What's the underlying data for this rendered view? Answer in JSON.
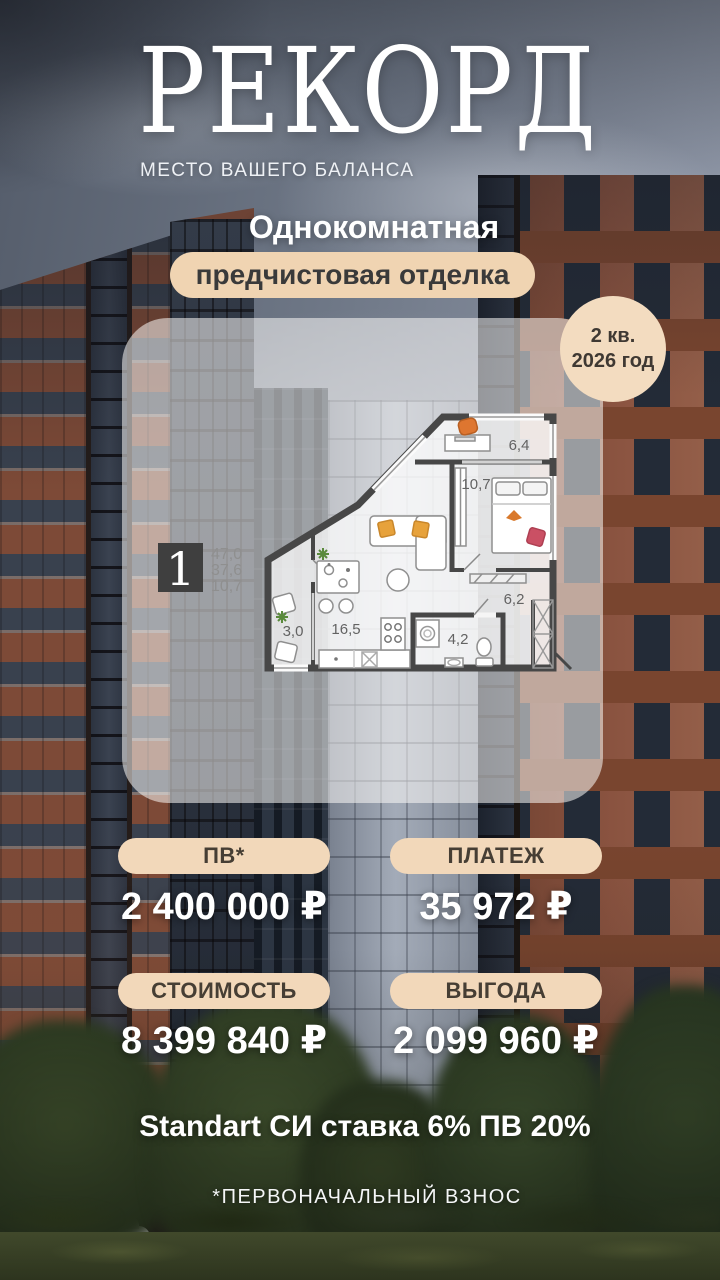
{
  "brand": {
    "logo": "РЕКОРД",
    "tagline": "МЕСТО ВАШЕГО БАЛАНСА"
  },
  "offer": {
    "room_type": "Однокомнатная",
    "finish": "предчистовая отделка",
    "completion_quarter": "2 кв.",
    "completion_year": "2026 год"
  },
  "floorplan": {
    "apartment_number": "1",
    "area_values": [
      "47,0",
      "37,6",
      "10,7"
    ],
    "rooms": [
      {
        "name": "balcony-top",
        "area": "6,4"
      },
      {
        "name": "bedroom",
        "area": "10,7"
      },
      {
        "name": "hallway",
        "area": "6,2"
      },
      {
        "name": "bathroom",
        "area": "4,2"
      },
      {
        "name": "kitchen-living",
        "area": "16,5"
      },
      {
        "name": "balcony-left",
        "area": "3,0"
      }
    ]
  },
  "pricing": {
    "items": [
      {
        "label": "ПВ*",
        "value": "2 400 000 ₽"
      },
      {
        "label": "ПЛАТЕЖ",
        "value": "35 972 ₽"
      },
      {
        "label": "СТОИМОСТЬ",
        "value": "8 399 840 ₽"
      },
      {
        "label": "ВЫГОДА",
        "value": "2 099 960 ₽"
      }
    ]
  },
  "program": {
    "line": "Standart СИ ставка 6% ПВ 20%",
    "footnote": "*ПЕРВОНАЧАЛЬНЫЙ ВЗНОС"
  },
  "street": {
    "store_sign": "ПРОДУКТЫ"
  },
  "colors": {
    "badge_beige": "#f2d8ba",
    "badge_text": "#463e34",
    "text_white": "#ffffff",
    "plan_wall": "#474747",
    "accent_orange": "#de7630",
    "accent_yellow": "#e7a23b",
    "accent_red": "#ca5064",
    "accent_green": "#5a8a3c"
  }
}
